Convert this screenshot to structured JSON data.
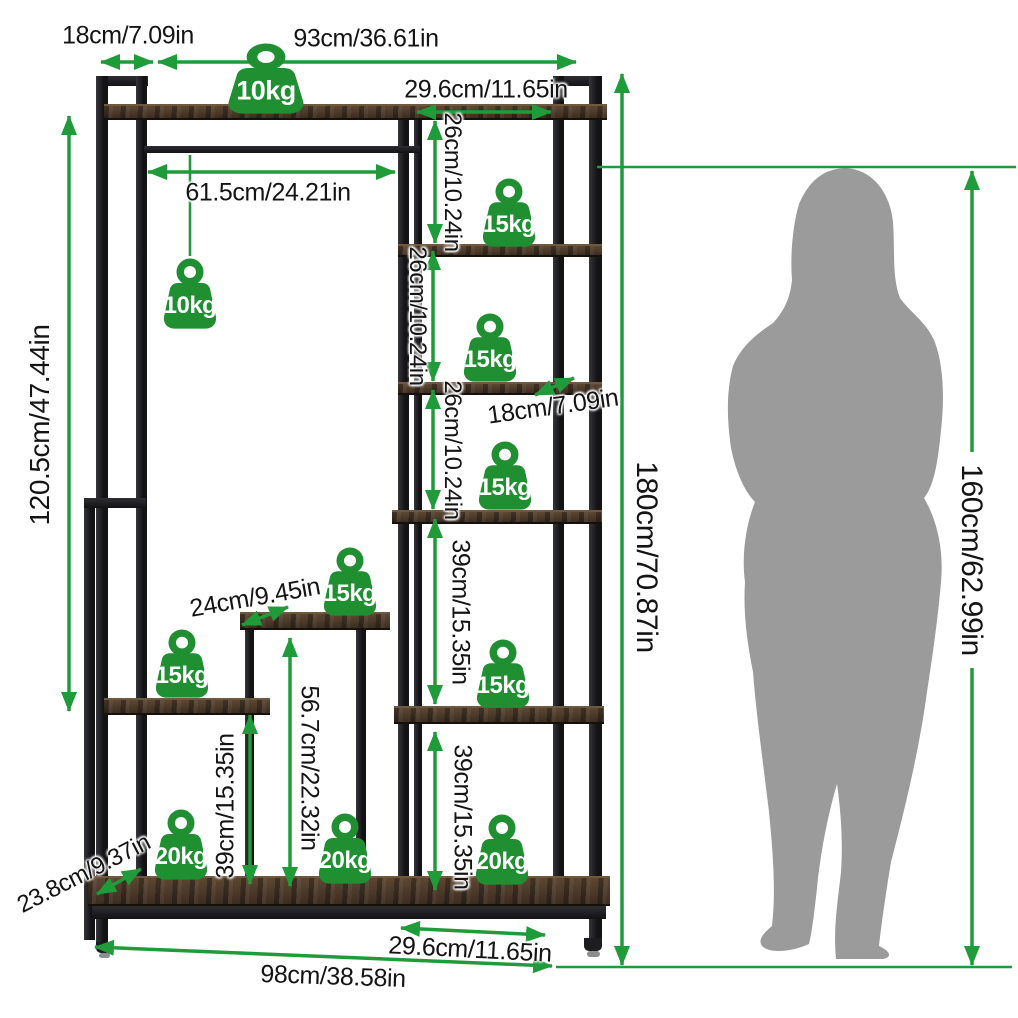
{
  "colors": {
    "accent_green": "#1f9b3a",
    "badge_green": "#1f8f31",
    "wood_brown": "#4a3729",
    "frame_black": "#1c1c1e",
    "silhouette_gray": "#9b9b9b"
  },
  "dims": {
    "top_depth": "18cm/7.09in",
    "top_width": "93cm/36.61in",
    "tower_width_top": "29.6cm/11.65in",
    "gap1": "26cm/10.24in",
    "gap2": "26cm/10.24in",
    "gap3": "26cm/10.24in",
    "rod_width": "61.5cm/24.21in",
    "left_height": "120.5cm/47.44in",
    "shelf_depth": "18cm/7.09in",
    "pillar_width": "24cm/9.45in",
    "pillar_height": "56.7cm/22.32in",
    "left_gap": "39cm/15.35in",
    "tower_gap4": "39cm/15.35in",
    "tower_gap5": "39cm/15.35in",
    "base_depth": "23.8cm/9.37in",
    "tower_width_bottom": "29.6cm/11.65in",
    "total_width": "98cm/38.58in",
    "total_height": "180cm/70.87in",
    "person_height": "160cm/62.99in"
  },
  "badges": [
    {
      "label": "10kg"
    },
    {
      "label": "10kg"
    },
    {
      "label": "15kg"
    },
    {
      "label": "15kg"
    },
    {
      "label": "15kg"
    },
    {
      "label": "15kg"
    },
    {
      "label": "15kg"
    },
    {
      "label": "15kg"
    },
    {
      "label": "20kg"
    },
    {
      "label": "20kg"
    },
    {
      "label": "20kg"
    }
  ]
}
